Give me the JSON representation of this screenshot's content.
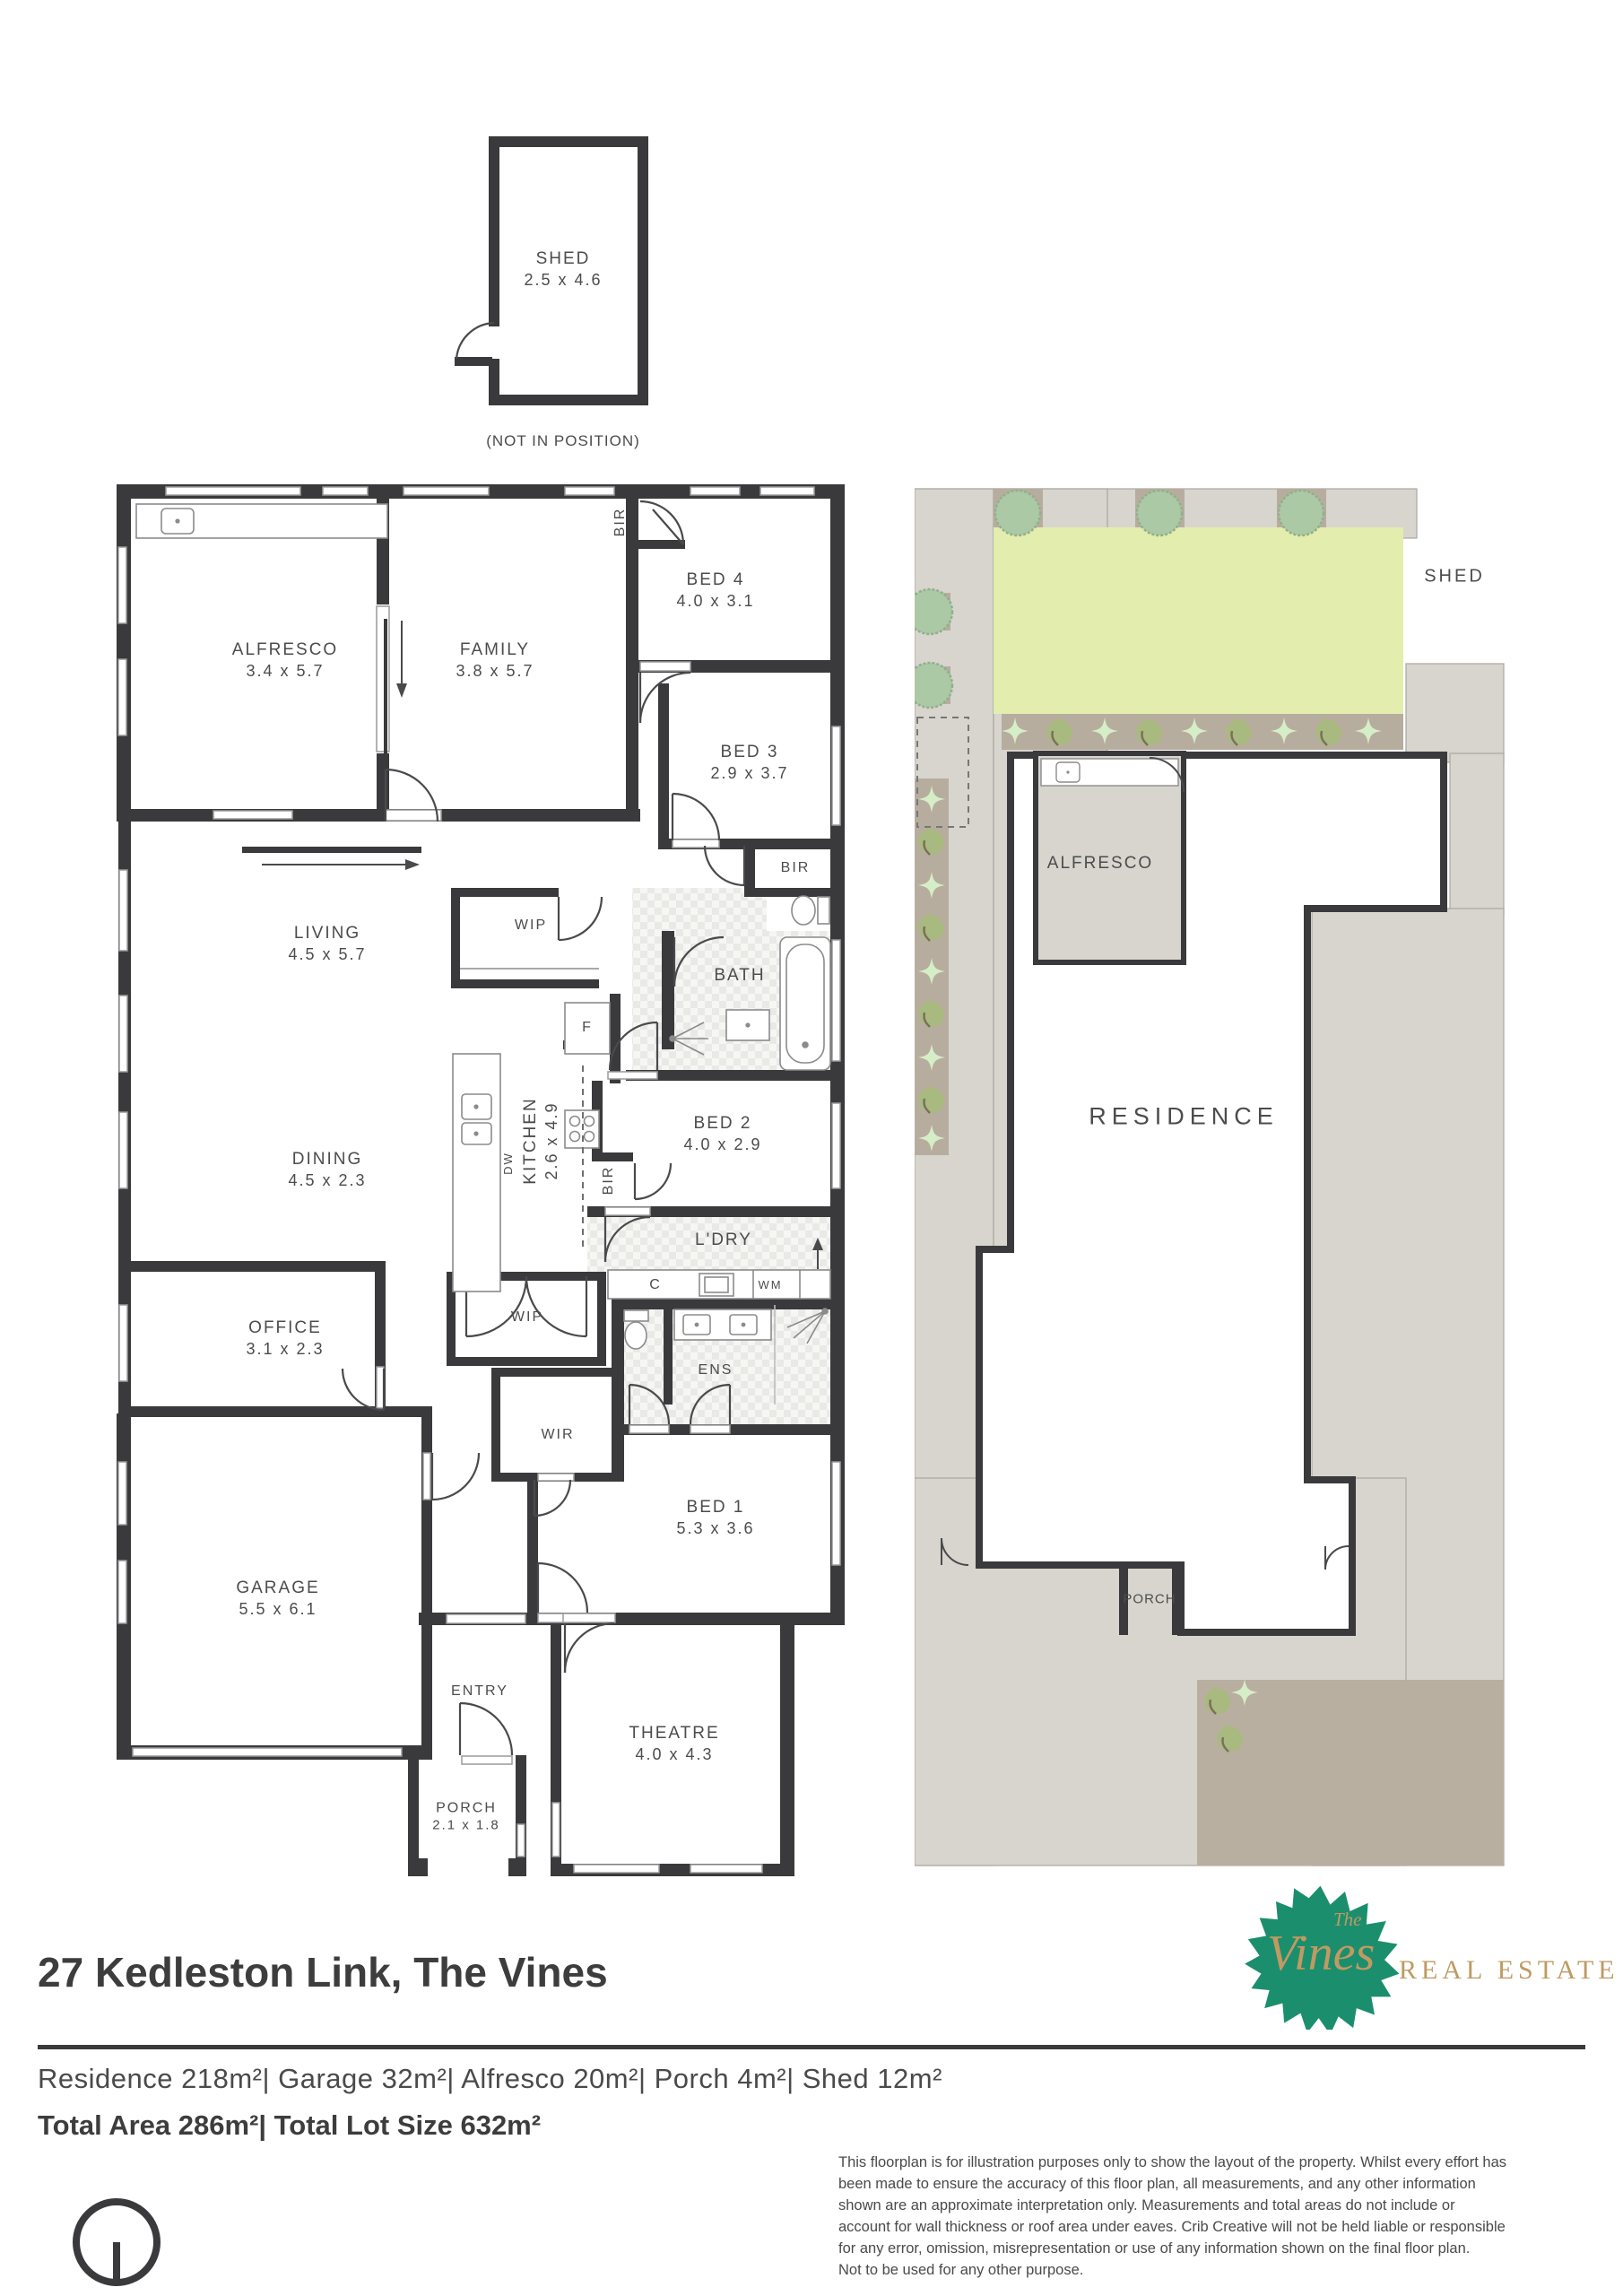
{
  "colors": {
    "wall": "#3a3a3c",
    "label_text": "#4c4c4c",
    "lawn": "#e3edad",
    "paving": "#d7d5ce",
    "garden_bed": "#b7ad9e",
    "paving_dark": "#b8afa0",
    "plant_light": "#d6eec7",
    "plant_olive": "#a9ba80",
    "tree": "#abc9a4",
    "logo_leaf_green": "#1b8e6d",
    "logo_gold": "#bf9a62"
  },
  "shed_diagram": {
    "name": "SHED",
    "dims": "2.5 x 4.6",
    "note": "(NOT IN POSITION)"
  },
  "floorplan": {
    "labels": [
      {
        "name": "ALFRESCO",
        "dims": "3.4 x 5.7"
      },
      {
        "name": "FAMILY",
        "dims": "3.8 x 5.7"
      },
      {
        "name": "BIR"
      },
      {
        "name": "BED 4",
        "dims": "4.0 x 3.1"
      },
      {
        "name": "BED 3",
        "dims": "2.9 x 3.7"
      },
      {
        "name": "BIR"
      },
      {
        "name": "LIVING",
        "dims": "4.5 x 5.7"
      },
      {
        "name": "WIP"
      },
      {
        "name": "BATH"
      },
      {
        "name": "F"
      },
      {
        "name": "KITCHEN",
        "dims": "2.6 x 4.9"
      },
      {
        "name": "DW"
      },
      {
        "name": "DINING",
        "dims": "4.5 x 2.3"
      },
      {
        "name": "BED 2",
        "dims": "4.0 x 2.9"
      },
      {
        "name": "BIR"
      },
      {
        "name": "L'DRY"
      },
      {
        "name": "C"
      },
      {
        "name": "WM"
      },
      {
        "name": "OFFICE",
        "dims": "3.1 x 2.3"
      },
      {
        "name": "WIP"
      },
      {
        "name": "ENS"
      },
      {
        "name": "WIR"
      },
      {
        "name": "BED 1",
        "dims": "5.3 x 3.6"
      },
      {
        "name": "GARAGE",
        "dims": "5.5 x 6.1"
      },
      {
        "name": "ENTRY"
      },
      {
        "name": "THEATRE",
        "dims": "4.0 x 4.3"
      },
      {
        "name": "PORCH",
        "dims": "2.1 x 1.8"
      }
    ]
  },
  "siteplan": {
    "labels": {
      "shed": "SHED",
      "alfresco": "ALFRESCO",
      "residence": "RESIDENCE",
      "porch": "PORCH"
    }
  },
  "footer": {
    "address": "27 Kedleston Link, The Vines",
    "areas": "Residence 218m²|  Garage  32m²|  Alfresco 20m²|  Porch  4m²|  Shed 12m²",
    "totals": "Total Area 286m²| Total Lot Size 632m²",
    "disclaimer": "This floorplan is for illustration purposes only to show the layout of the property. Whilst every effort has\nbeen made to ensure the accuracy of this floor plan, all measurements, and any other information\nshown are an approximate interpretation only. Measurements and total areas do not include or\naccount for wall thickness or roof area under eaves. Crib Creative will not be held liable or responsible\nfor any error, omission, misrepresentation or use of any information shown on the final floor plan.\nNot to be used for any other purpose."
  },
  "brand": {
    "the": "The",
    "name": "Vines",
    "tagline": "REAL ESTATE"
  }
}
